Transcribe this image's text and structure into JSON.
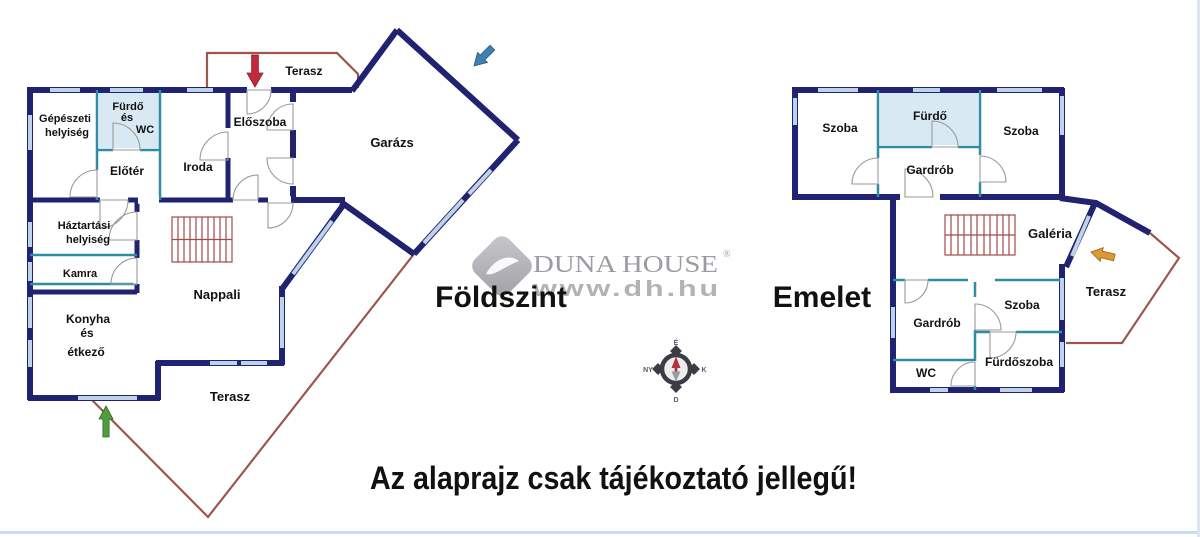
{
  "disclaimer": "Az alaprajz csak tájékoztató jellegű!",
  "watermark": {
    "logo_text": "DUNA HOUSE",
    "registered": "®",
    "url": "www.dh.hu"
  },
  "ground_floor": {
    "title": "Földszint",
    "rooms": {
      "gepeszeti_1": "Gépészeti",
      "gepeszeti_2": "helyiség",
      "furdo_1": "Fürdő",
      "furdo_2": "és",
      "furdo_3": "WC",
      "eloszoba": "Előszoba",
      "eloter": "Előtér",
      "iroda": "Iroda",
      "garazs": "Garázs",
      "haztartasi_1": "Háztartási",
      "haztartasi_2": "helyiség",
      "kamra": "Kamra",
      "konyha_1": "Konyha",
      "konyha_2": "és",
      "konyha_3": "étkező",
      "nappali": "Nappali",
      "terasz_felso": "Terasz",
      "terasz_also": "Terasz"
    }
  },
  "upper_floor": {
    "title": "Emelet",
    "rooms": {
      "szoba_bal": "Szoba",
      "furdo": "Fürdő",
      "szoba_jobb": "Szoba",
      "gardrob_felso": "Gardrób",
      "galeria": "Galéria",
      "terasz": "Terasz",
      "szoba_kozep": "Szoba",
      "gardrob_also": "Gardrób",
      "wc": "WC",
      "furdoszoba": "Fürdőszoba"
    }
  },
  "compass": {
    "north": "É",
    "south": "D",
    "east": "K",
    "west": "NY"
  },
  "colors": {
    "wall": "#1f2370",
    "partition": "#2e8ca4",
    "window": "#bed3e7",
    "room_tint": "#d8e9f4",
    "terrace_line": "#9c564c",
    "stair_line": "#a34a4a",
    "door_arc": "#9a9a9a",
    "arrow_red": "#c2293d",
    "arrow_green": "#4f9d3c",
    "arrow_blue": "#3f80b4",
    "arrow_orange": "#dd9833",
    "label": "#111111",
    "watermark_gray": "#9b9ca1",
    "url_gray": "#b2b3b7",
    "compass_dark": "#3c3c44",
    "compass_red": "#b03440",
    "edge_bottom": "#c9dcee",
    "edge_right": "#dde4ee"
  }
}
